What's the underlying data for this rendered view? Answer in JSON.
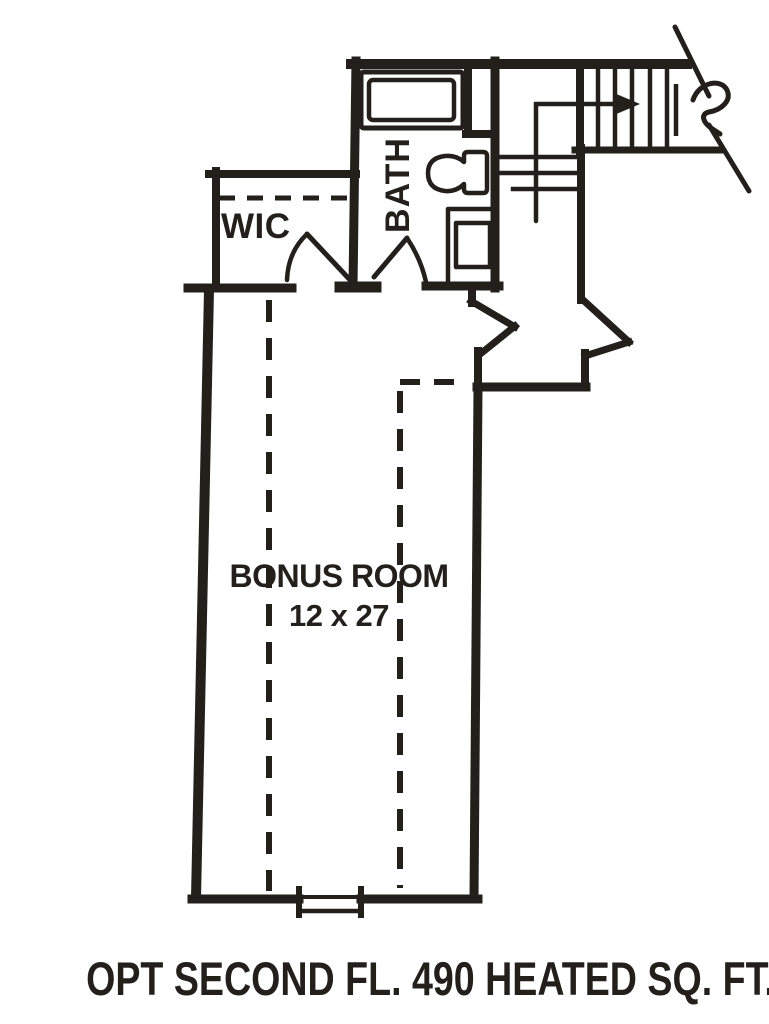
{
  "plan": {
    "caption": "OPT SECOND FL. 490 HEATED SQ. FT.",
    "rooms": [
      {
        "label": "WIC"
      },
      {
        "label": "BATH"
      },
      {
        "label": "BONUS ROOM",
        "dimensions": "12 x 27"
      }
    ],
    "symbols": {
      "stairs": "stair-run-with-direction-arrow-and-break-line",
      "fixtures": [
        "bathtub",
        "toilet",
        "sink-vanity"
      ],
      "doors": [
        "wic-door-swing",
        "bath-door-swing"
      ],
      "window": "bonus-room-window",
      "dashed_lines": [
        "wic-shelf-line",
        "ceiling-slope-break-lines"
      ]
    },
    "colors": {
      "ink": "#231f1b",
      "paper": "#ffffff"
    }
  }
}
